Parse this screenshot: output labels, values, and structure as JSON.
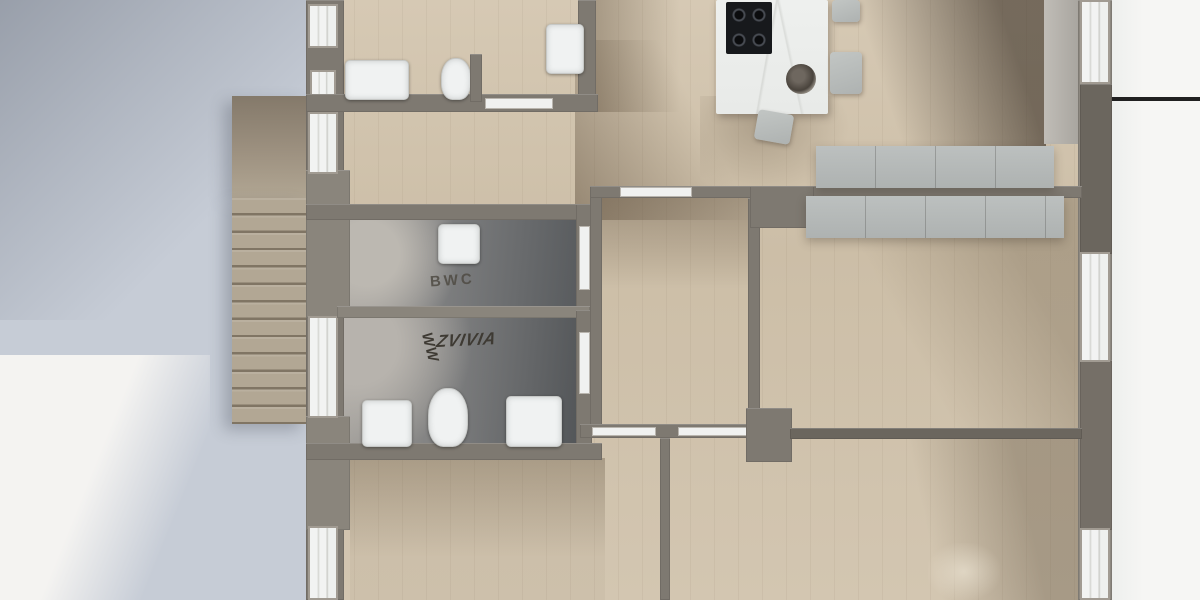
{
  "meta": {
    "title": "Top-down 3D apartment floor plan render",
    "view": "top-down",
    "stairs_step_count": 13
  },
  "labels": {
    "guest_wc": "BWC",
    "bath_scribble_rotated": "WW",
    "bath_scribble_main": "ZVIVIA"
  },
  "rooms": [
    {
      "name": "bathroom-top",
      "floor": "dark-tile",
      "fixtures": [
        "bathtub",
        "toilet",
        "shower-basin"
      ]
    },
    {
      "name": "guest-wc",
      "label": "BWC",
      "floor": "dark-tile",
      "fixtures": [
        "washbasin"
      ]
    },
    {
      "name": "bathroom-lower",
      "label": "WW ZVIVIA",
      "floor": "dark-tile",
      "fixtures": [
        "washbasin",
        "toilet",
        "washbasin"
      ]
    },
    {
      "name": "kitchen-living",
      "floor": "wood",
      "fixtures": [
        "kitchen-island",
        "cooktop",
        "bar-stool",
        "bar-stool",
        "bar-stool",
        "decor-bowl",
        "counter-row"
      ]
    },
    {
      "name": "center-room",
      "floor": "wood"
    },
    {
      "name": "bedroom-right",
      "floor": "wood",
      "fixtures": [
        "sideboard"
      ]
    },
    {
      "name": "bedroom-bottom-left",
      "floor": "wood"
    },
    {
      "name": "bedroom-bottom-center",
      "floor": "wood"
    },
    {
      "name": "exterior-stairs",
      "floor": "concrete",
      "steps": 13
    }
  ],
  "colors": {
    "background_left": "#c6ccd6",
    "background_right": "#f6f6f4",
    "background_bottom_left": "#f4f3f1",
    "wall": "#7e7971",
    "wall_dark_pier": "#6b665e",
    "window_frame": "#a19b92",
    "window_glass": "#f2f3f2",
    "wood_floor": "#d3c6b1",
    "wood_shadow": "#8a7a66",
    "tile_light": "#a8a7a4",
    "tile_dark": "#55585b",
    "fixture_white": "#f0f2f2",
    "island_marble": "#eef0ee",
    "cooktop_black": "#17191c",
    "cabinet_gray": "#b7bbba",
    "stairs_concrete": "#b2a794",
    "label_ink": "#4f4b43",
    "leader_line": "#202020"
  }
}
